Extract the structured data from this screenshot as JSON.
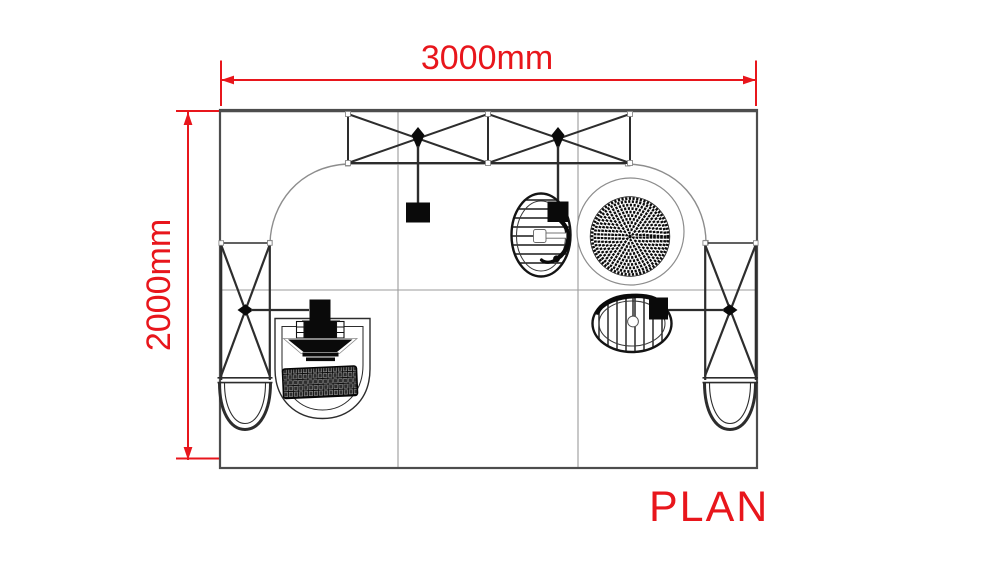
{
  "title_label": "PLAN",
  "dimensions": {
    "width": {
      "label": "3000mm",
      "value_mm": 3000,
      "orientation": "horizontal"
    },
    "height": {
      "label": "2000mm",
      "value_mm": 2000,
      "orientation": "vertical"
    }
  },
  "colors": {
    "annotation_red": "#e8161c",
    "line_dark": "#2d2d2d",
    "edge_gray": "#4d4d4d",
    "grid_gray": "#9b9b9b",
    "wall_gray": "#8d8d8d",
    "fill_black": "#0a0a0a",
    "background": "#ffffff"
  },
  "drawing": {
    "type": "exhibition-booth-floor-plan",
    "floor_panels": {
      "columns": 3,
      "rows": 2
    },
    "top_truss_bays": 2,
    "side_trusses": 2,
    "hanging_spotlights": 2,
    "arm_spotlights": 2,
    "podium_bowls": 2,
    "chairs": 2,
    "round_table": 1,
    "counter_workstation": "monitor + keyboard"
  }
}
